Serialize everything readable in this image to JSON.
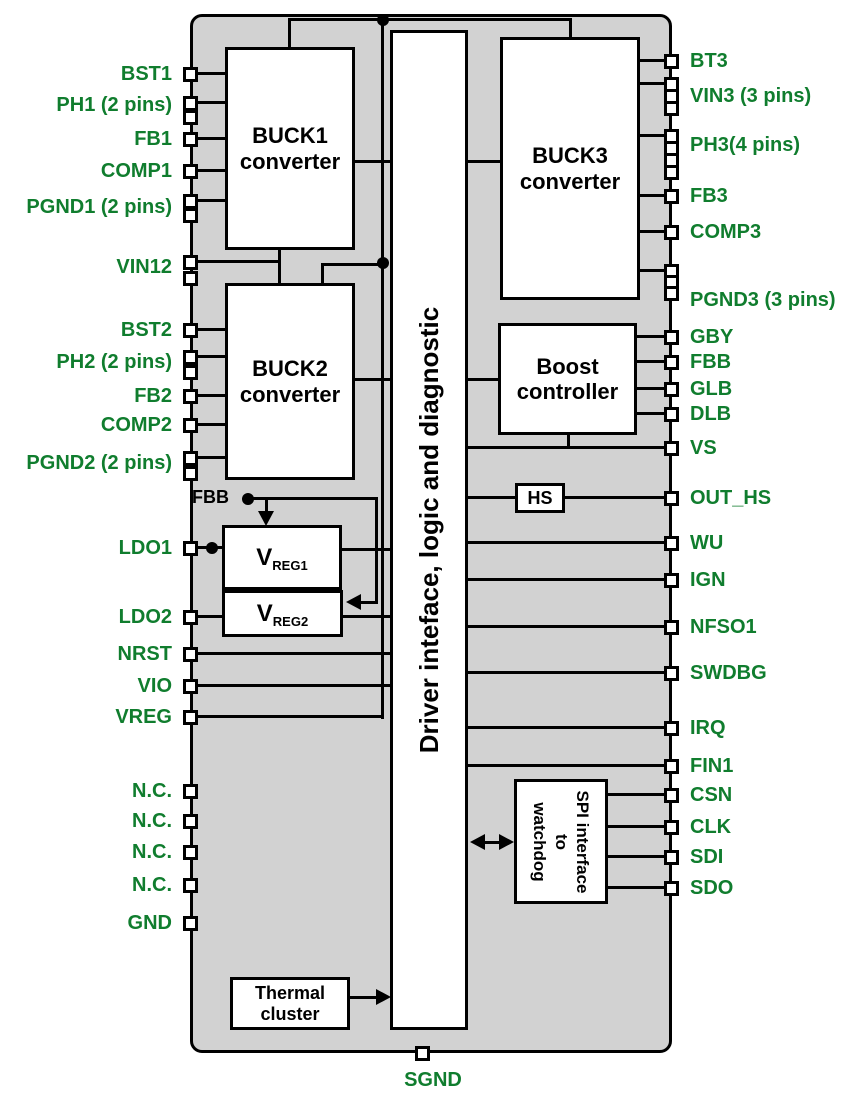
{
  "blocks": {
    "buck1": "BUCK1\nconverter",
    "buck2": "BUCK2\nconverter",
    "buck3": "BUCK3\nconverter",
    "boost": "Boost\ncontroller",
    "hs": "HS",
    "vreg1": {
      "main": "V",
      "sub": "REG1"
    },
    "vreg2": {
      "main": "V",
      "sub": "REG2"
    },
    "driver": "Driver inteface, logic and diagnostic",
    "spi": "SPI interface\nto\nwatchdog",
    "thermal": "Thermal\ncluster",
    "fbb_node": "FBB"
  },
  "pins_left": [
    "BST1",
    "PH1 (2 pins)",
    "FB1",
    "COMP1",
    "PGND1 (2 pins)",
    "VIN12",
    "BST2",
    "PH2 (2 pins)",
    "FB2",
    "COMP2",
    "PGND2 (2 pins)",
    "LDO1",
    "LDO2",
    "NRST",
    "VIO",
    "VREG",
    "N.C.",
    "N.C.",
    "N.C.",
    "N.C.",
    "GND"
  ],
  "pins_right": [
    "BT3",
    "VIN3 (3 pins)",
    "PH3(4 pins)",
    "FB3",
    "COMP3",
    "PGND3 (3 pins)",
    "GBY",
    "FBB",
    "GLB",
    "DLB",
    "VS",
    "OUT_HS",
    "WU",
    "IGN",
    "NFSO1",
    "SWDBG",
    "IRQ",
    "FIN1",
    "CSN",
    "CLK",
    "SDI",
    "SDO"
  ],
  "pin_bottom": "SGND",
  "colors": {
    "pin_label_green": "#107d2e",
    "chip_fill": "#d2d2d2",
    "block_fill": "#ffffff",
    "wire": "#000000"
  }
}
